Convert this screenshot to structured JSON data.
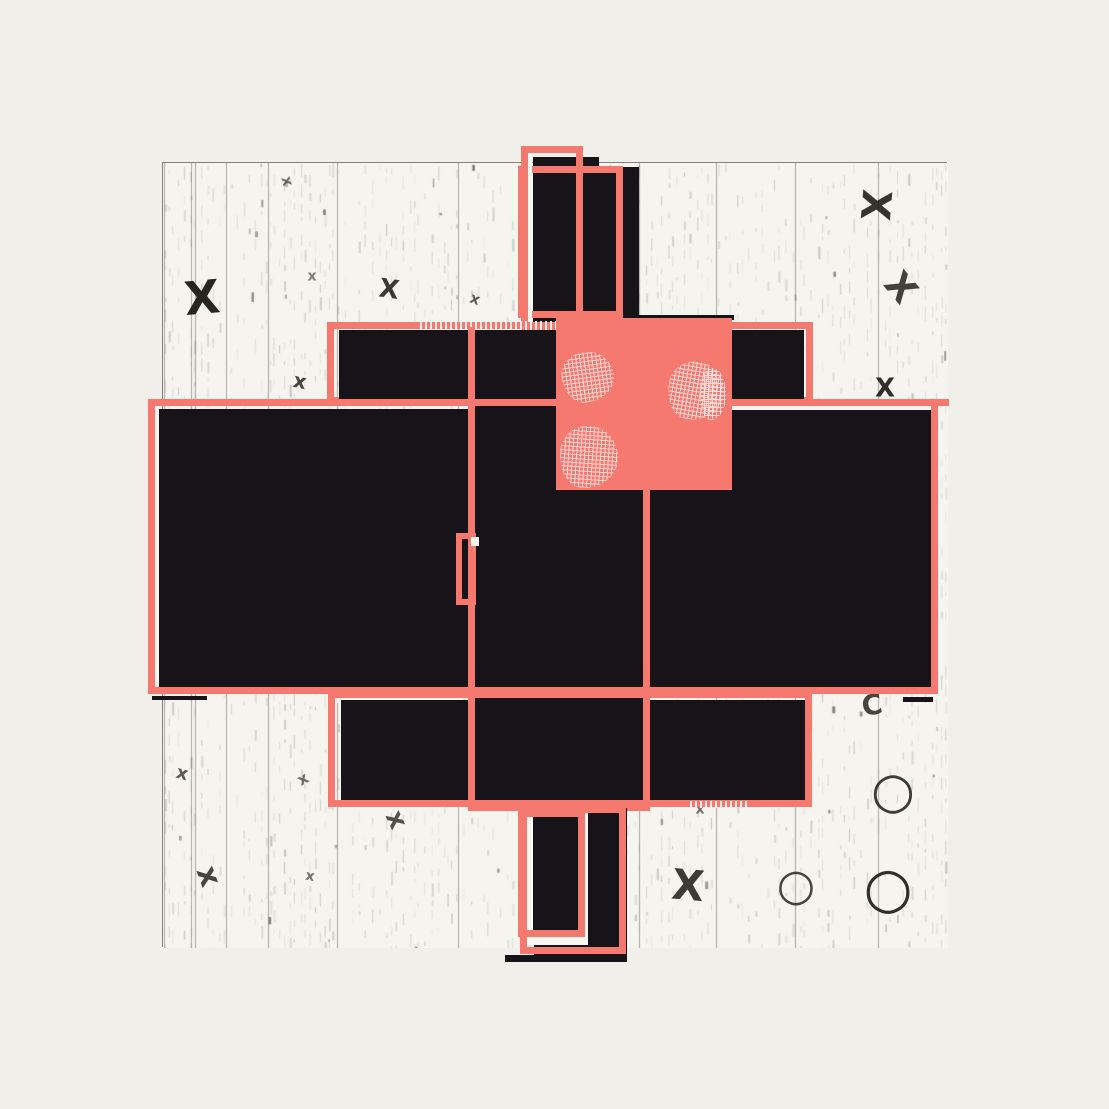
{
  "artwork": {
    "title": "abstract-composition",
    "stage": {
      "w": 1109,
      "h": 1109,
      "background": "#f0efe9"
    },
    "palette": {
      "coral": "#f6796f",
      "black": "#161319",
      "white": "#f7f6f1",
      "paper": "#f5f4ef",
      "paper_border": "#83837d",
      "texture_gray": "#8c8c85",
      "glyph_ink": "#1d1a16"
    },
    "paper": {
      "x": 162,
      "y": 162,
      "w": 785,
      "h": 785,
      "seams": [
        1,
        28,
        32,
        63,
        105,
        174,
        295,
        421,
        476,
        553,
        632,
        715
      ]
    },
    "shapes": [
      {
        "name": "top-column-black-left",
        "type": "fill",
        "x": 533,
        "y": 157,
        "w": 66,
        "h": 173,
        "color": "black"
      },
      {
        "name": "top-column-black-right",
        "type": "fill",
        "x": 586,
        "y": 167,
        "w": 53,
        "h": 163,
        "color": "black"
      },
      {
        "name": "top-outline-wide",
        "type": "stroke",
        "x": 518,
        "y": 166,
        "w": 105,
        "h": 152,
        "color": "coral",
        "stroke": 7
      },
      {
        "name": "top-outline-white-inner",
        "type": "fill",
        "x": 528,
        "y": 153,
        "w": 4,
        "h": 174,
        "color": "white"
      },
      {
        "name": "top-outline-tall",
        "type": "stroke",
        "x": 521,
        "y": 146,
        "w": 62,
        "h": 184,
        "color": "coral",
        "stroke": 7
      },
      {
        "name": "upper-band-outline",
        "type": "stroke",
        "x": 327,
        "y": 322,
        "w": 486,
        "h": 82,
        "color": "coral",
        "stroke": 7
      },
      {
        "name": "upper-band-halftone",
        "type": "dots",
        "x": 420,
        "y": 321,
        "w": 140,
        "h": 9
      },
      {
        "name": "upper-band-black",
        "type": "fill",
        "x": 339,
        "y": 330,
        "w": 465,
        "h": 71,
        "color": "black"
      },
      {
        "name": "left-slab-black",
        "type": "fill",
        "x": 159,
        "y": 409,
        "w": 311,
        "h": 279,
        "color": "black"
      },
      {
        "name": "center-column-black",
        "type": "fill",
        "x": 468,
        "y": 330,
        "w": 182,
        "h": 477,
        "color": "black"
      },
      {
        "name": "right-slab-black",
        "type": "fill",
        "x": 648,
        "y": 410,
        "w": 287,
        "h": 280,
        "color": "black"
      },
      {
        "name": "slab-outline-white-left",
        "type": "fill",
        "x": 155,
        "y": 406,
        "w": 4,
        "h": 276,
        "color": "white"
      },
      {
        "name": "slab-outline-white-right",
        "type": "fill",
        "x": 737,
        "y": 406,
        "w": 194,
        "h": 4,
        "color": "white"
      },
      {
        "name": "slab-outline",
        "type": "stroke",
        "x": 148,
        "y": 399,
        "w": 790,
        "h": 295,
        "color": "coral",
        "stroke": 7
      },
      {
        "name": "slab-outline-overshoot",
        "type": "fill",
        "x": 930,
        "y": 399,
        "w": 19,
        "h": 7,
        "color": "coral"
      },
      {
        "name": "left-slab-shadow",
        "type": "fill",
        "x": 152,
        "y": 696,
        "w": 55,
        "h": 4,
        "color": "black"
      },
      {
        "name": "right-slab-shadow",
        "type": "fill",
        "x": 903,
        "y": 697,
        "w": 30,
        "h": 5,
        "color": "black"
      },
      {
        "name": "lower-band-white-inner",
        "type": "fill",
        "x": 337,
        "y": 698,
        "w": 125,
        "h": 5,
        "color": "white"
      },
      {
        "name": "lower-band-black",
        "type": "fill",
        "x": 341,
        "y": 700,
        "w": 466,
        "h": 100,
        "color": "black"
      },
      {
        "name": "lower-band-outline",
        "type": "stroke",
        "x": 328,
        "y": 691,
        "w": 484,
        "h": 116,
        "color": "coral",
        "stroke": 7
      },
      {
        "name": "lower-band-halftone",
        "type": "dots",
        "x": 690,
        "y": 801,
        "w": 60,
        "h": 7
      },
      {
        "name": "center-column-outline-left",
        "type": "fill",
        "x": 468,
        "y": 327,
        "w": 7,
        "h": 484,
        "color": "coral"
      },
      {
        "name": "center-column-outline-right",
        "type": "fill",
        "x": 643,
        "y": 490,
        "w": 7,
        "h": 321,
        "color": "coral"
      },
      {
        "name": "center-column-outline-bottom",
        "type": "fill",
        "x": 468,
        "y": 803,
        "w": 182,
        "h": 8,
        "color": "coral"
      },
      {
        "name": "notch-outline",
        "type": "stroke",
        "x": 456,
        "y": 533,
        "w": 20,
        "h": 72,
        "color": "coral",
        "stroke": 6
      },
      {
        "name": "notch-white-square",
        "type": "fill",
        "x": 471,
        "y": 537,
        "w": 8,
        "h": 9,
        "color": "white"
      },
      {
        "name": "coral-square-top-shadow",
        "type": "fill",
        "x": 632,
        "y": 315,
        "w": 102,
        "h": 5,
        "color": "black"
      },
      {
        "name": "coral-square",
        "type": "fill",
        "x": 556,
        "y": 318,
        "w": 176,
        "h": 172,
        "color": "coral"
      },
      {
        "name": "coral-square-patch-1",
        "type": "patch",
        "x": 562,
        "y": 352,
        "w": 52,
        "h": 50,
        "rot": -8
      },
      {
        "name": "coral-square-patch-2",
        "type": "patch",
        "x": 668,
        "y": 362,
        "w": 56,
        "h": 58,
        "rot": 10
      },
      {
        "name": "coral-square-patch-3",
        "type": "patch",
        "x": 560,
        "y": 426,
        "w": 58,
        "h": 62,
        "rot": 4
      },
      {
        "name": "coral-square-patch-4",
        "type": "patch",
        "x": 700,
        "y": 368,
        "w": 26,
        "h": 52,
        "rot": 0
      },
      {
        "name": "bottom-column-black",
        "type": "fill",
        "x": 534,
        "y": 808,
        "w": 93,
        "h": 149,
        "color": "black"
      },
      {
        "name": "bottom-column-white-inset",
        "type": "fill",
        "x": 526,
        "y": 812,
        "w": 62,
        "h": 133,
        "color": "white"
      },
      {
        "name": "bottom-column-inner-black",
        "type": "fill",
        "x": 533,
        "y": 816,
        "w": 48,
        "h": 117,
        "color": "black"
      },
      {
        "name": "bottom-outline-wide",
        "type": "stroke",
        "x": 520,
        "y": 806,
        "w": 106,
        "h": 148,
        "color": "coral",
        "stroke": 7
      },
      {
        "name": "bottom-outline-tall",
        "type": "stroke",
        "x": 518,
        "y": 810,
        "w": 67,
        "h": 127,
        "color": "coral",
        "stroke": 7
      },
      {
        "name": "bottom-column-shadow",
        "type": "fill",
        "x": 505,
        "y": 955,
        "w": 122,
        "h": 7,
        "color": "black"
      }
    ],
    "glyphs": [
      {
        "char": "X",
        "x": 202,
        "y": 300,
        "size": 46,
        "rot": -5,
        "opacity": 0.95
      },
      {
        "char": "x",
        "x": 287,
        "y": 182,
        "size": 15,
        "rot": 75,
        "opacity": 0.6
      },
      {
        "char": "x",
        "x": 312,
        "y": 277,
        "size": 14,
        "rot": 0,
        "opacity": 0.55
      },
      {
        "char": "x",
        "x": 300,
        "y": 382,
        "size": 20,
        "rot": 12,
        "opacity": 0.8
      },
      {
        "char": "X",
        "x": 389,
        "y": 291,
        "size": 26,
        "rot": 8,
        "opacity": 0.85
      },
      {
        "char": "x",
        "x": 475,
        "y": 300,
        "size": 15,
        "rot": 20,
        "opacity": 0.7
      },
      {
        "char": "X",
        "x": 875,
        "y": 207,
        "size": 40,
        "rot": 95,
        "opacity": 0.88
      },
      {
        "char": "X",
        "x": 900,
        "y": 290,
        "size": 36,
        "rot": 50,
        "opacity": 0.82
      },
      {
        "char": "X",
        "x": 885,
        "y": 390,
        "size": 26,
        "rot": 0,
        "opacity": 0.9
      },
      {
        "char": "C",
        "x": 872,
        "y": 707,
        "size": 28,
        "rot": -10,
        "opacity": 0.8
      },
      {
        "char": "○",
        "x": 893,
        "y": 793,
        "size": 50,
        "rot": 0,
        "opacity": 0.85
      },
      {
        "char": "○",
        "x": 888,
        "y": 892,
        "size": 56,
        "rot": 0,
        "opacity": 0.9
      },
      {
        "char": "○",
        "x": 796,
        "y": 888,
        "size": 44,
        "rot": 0,
        "opacity": 0.8
      },
      {
        "char": "X",
        "x": 688,
        "y": 888,
        "size": 42,
        "rot": 5,
        "opacity": 0.85
      },
      {
        "char": "x",
        "x": 208,
        "y": 878,
        "size": 30,
        "rot": 70,
        "opacity": 0.8
      },
      {
        "char": "x",
        "x": 182,
        "y": 775,
        "size": 18,
        "rot": 15,
        "opacity": 0.7
      },
      {
        "char": "x",
        "x": 303,
        "y": 780,
        "size": 16,
        "rot": -30,
        "opacity": 0.6
      },
      {
        "char": "x",
        "x": 396,
        "y": 821,
        "size": 26,
        "rot": 65,
        "opacity": 0.75
      },
      {
        "char": "x",
        "x": 310,
        "y": 877,
        "size": 14,
        "rot": 10,
        "opacity": 0.6
      },
      {
        "char": "x",
        "x": 700,
        "y": 810,
        "size": 14,
        "rot": 0,
        "opacity": 0.6
      }
    ]
  }
}
